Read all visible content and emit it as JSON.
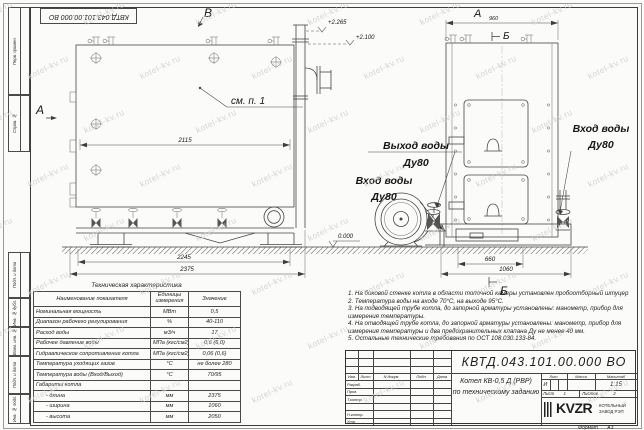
{
  "watermark": {
    "text": "kotel-kv.ru"
  },
  "corner_stamp": {
    "doc_number": "КВТД.043.101.00.000 ВО"
  },
  "margin_labels": [
    "Перв. примен.",
    "Справ. №",
    "Подп. и дата",
    "Инв. № дубл.",
    "Взам. инв. №",
    "Подп. и дата",
    "Инв. № подл."
  ],
  "drawing": {
    "view_a_left": "А",
    "view_b_top": "В",
    "view_a_right": "А",
    "view_b_right": "Б",
    "view_b_bottom": "Б",
    "elev_1": "+2.265",
    "elev_2": "+2.100",
    "elev_zero": "0.000",
    "dim_2115": "2115",
    "dim_2245": "2245",
    "dim_2375": "2375",
    "dim_960": "960",
    "dim_660": "660",
    "dim_1060": "1060",
    "see_note": "см. п. 1",
    "out_label": "Выход воды",
    "out_dn": "Ду80",
    "in_left_label": "Вход воды",
    "in_left_dn": "Ду80",
    "in_right_label": "Вход воды",
    "in_right_dn": "Ду80"
  },
  "tech_table": {
    "title": "Техническая характеристика",
    "headers": [
      "Наименование показателя",
      "Единицы измерения",
      "Значение"
    ],
    "rows": [
      [
        "Номинальная мощность",
        "МВт",
        "0,5"
      ],
      [
        "Диапазон рабочего регулирования",
        "%",
        "40-110"
      ],
      [
        "Расход воды",
        "м3/ч",
        "17"
      ],
      [
        "Рабочее давление воды",
        "МПа (кгс/см2)",
        "0,6 (6,0)"
      ],
      [
        "Гидравлическое сопротивление котла",
        "МПа (кгс/см2)",
        "0,06 (0,6)"
      ],
      [
        "Температура уходящих газов",
        "°С",
        "не более 280"
      ],
      [
        "Температура воды (Вход/Выход)",
        "°С",
        "70/95"
      ],
      [
        "Габариты котла",
        "",
        ""
      ],
      [
        "- длина",
        "мм",
        "2375"
      ],
      [
        "- ширина",
        "мм",
        "1060"
      ],
      [
        "- высота",
        "мм",
        "2050"
      ]
    ]
  },
  "notes": [
    "1. На боковой стенке котла в области топочной камеры установлен пробоотборный штуцер",
    "2. Температура воды на входе 70°С, на выходе 95°С.",
    "3. На подводящей трубе котла, до запорной арматуры установлены: манометр, прибор для измерения температуры.",
    "4. На отводящей трубе котла, до запорной арматуры установлены: манометр, прибор для измерения температуры и два предохранительных клапана Ду не менее 40 мм.",
    "5. Остальные технические требования по ОСТ 108.030.133-84."
  ],
  "title_block": {
    "doc_number": "КВТД.043.101.00.000 ВО",
    "rev_headers": [
      "Изм.",
      "Лист",
      "N докум.",
      "Подп.",
      "Дата"
    ],
    "sig_rows": [
      "Разраб.",
      "Пров.",
      "Т.контр.",
      "",
      "Н.контр.",
      "Утв."
    ],
    "product_line1": "Котел КВ-0,5 Д (РВР)",
    "product_line2": "по техническому заданию",
    "lit_label": "Лит.",
    "lit_value": "И",
    "mass_label": "Масса",
    "mass_value": "",
    "scale_label": "Масштаб",
    "scale_value": "1:15",
    "sheet_label": "Лист",
    "sheet_value": "1",
    "sheets_label": "Листов",
    "sheets_value": "2",
    "logo_text": "KVZR",
    "org_line1": "КОТЕЛЬНЫЙ",
    "org_line2": "ЗАВОД РЭП",
    "format_label": "Формат",
    "format_value": "А3"
  }
}
